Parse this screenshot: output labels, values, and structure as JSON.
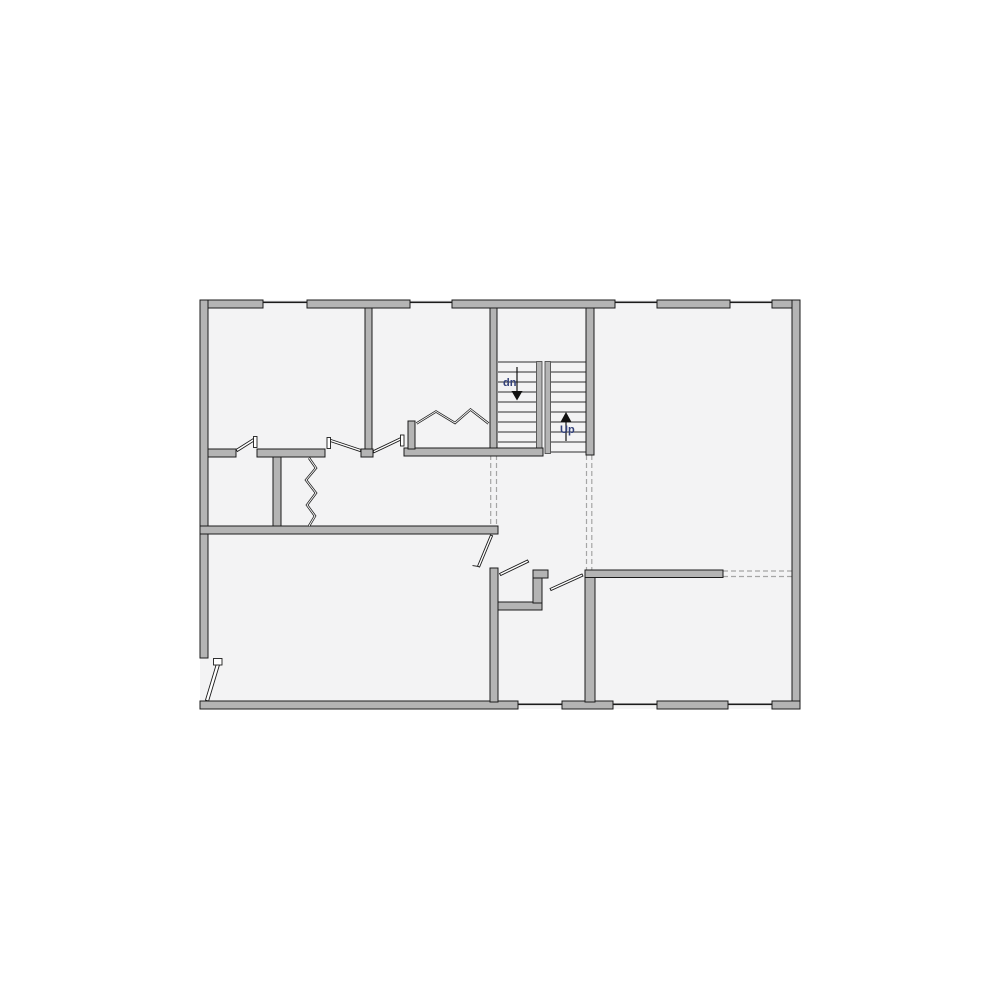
{
  "plan": {
    "type": "second-floor-plan",
    "stairs": {
      "down_label": "dn",
      "up_label": "Up"
    },
    "colors": {
      "wall_fill": "#b4b4b4",
      "wall_outline": "#1b1b1b",
      "floor": "#f3f3f4",
      "stair_tread": "#2e2e2e",
      "dashed_opening": "#a5a5a5",
      "stair_label": "#33417a",
      "background": "#ffffff"
    }
  }
}
